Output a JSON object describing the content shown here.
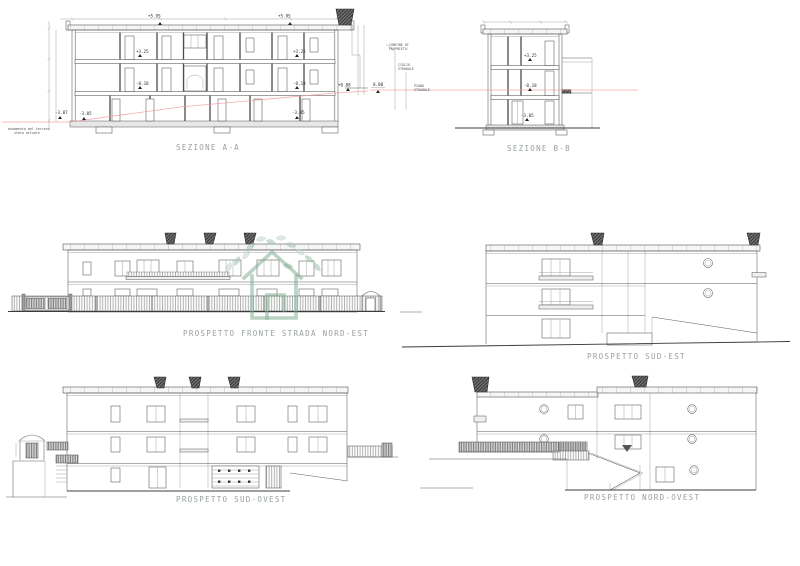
{
  "colors": {
    "accent_green": "#7fae93",
    "terrain_pink": "#f09aa0",
    "line": "#4a4a4a",
    "label_gray": "#98a09e"
  },
  "sezione_aa": {
    "title": "SEZIONE A-A",
    "terrain_note_1": "andamento del terreno",
    "terrain_note_2": "stato attuale",
    "dim_roof_l": "+5.95",
    "dim_roof_r": "+5.95",
    "dim_f2_l": "+3.25",
    "dim_f2_r": "+3.25",
    "dim_f1_l": "-0.18",
    "dim_f1_r": "-0.18",
    "dim_ground_r": "+0.08",
    "dim_terrain": "-3.07",
    "dim_base_l": "-3.05",
    "dim_base_r": "-3.85"
  },
  "sezione_bb": {
    "title": "SEZIONE B-B",
    "dim_f2": "+3.25",
    "dim_f1": "-0.18",
    "dim_base": "-3.05",
    "dim_zero": "0.00",
    "confine_1": "CONFINE DI",
    "confine_2": "PROPRIETA'",
    "ciglio_1": "CIGLIO",
    "ciglio_2": "STRADALE",
    "piano_1": "PIANO",
    "piano_2": "STRADALE"
  },
  "prospetti": {
    "nord_est": "PROSPETTO FRONTE STRADA NORD-EST",
    "sud_est": "PROSPETTO  SUD-EST",
    "sud_ovest": "PROSPETTO  SUD-OVEST",
    "nord_ovest": "PROSPETTO  NORD-OVEST"
  }
}
